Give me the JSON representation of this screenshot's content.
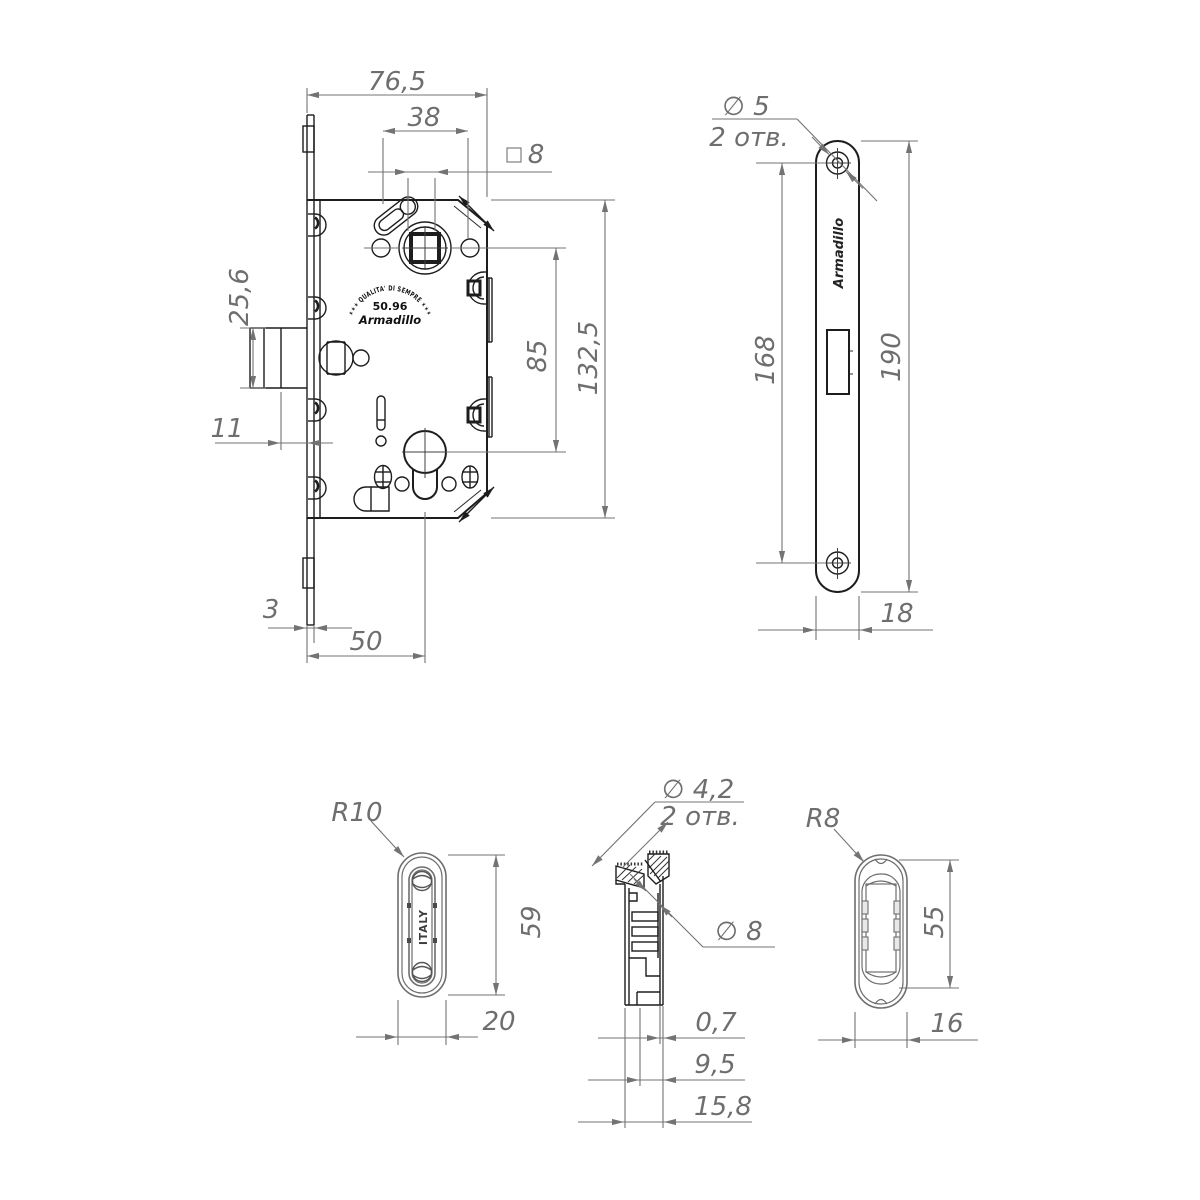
{
  "drawing": {
    "type": "technical-drawing",
    "product": "magnetic mortise lock",
    "lock_body": {
      "dim_total_width": "76,5",
      "dim_handle_span": "38",
      "dim_square_symbol": "□",
      "dim_square_value": "8",
      "dim_latch_height": "25,6",
      "dim_latch_offset": "11",
      "dim_faceplate_thickness": "3",
      "dim_backset": "50",
      "dim_centers_distance": "85",
      "dim_body_height": "132,5",
      "logo": {
        "arc_text": "✶✶✶ QUALITA' DI SEMPRE ✶✶✶",
        "number": "50.96",
        "brand": "Armadillo"
      }
    },
    "face_plate": {
      "hole_diameter": "∅ 5",
      "holes_count": "2 отв.",
      "dim_hole_centers": "168",
      "dim_length": "190",
      "dim_width": "18",
      "brand": "Armadillo"
    },
    "strike_plate_front": {
      "radius": "R10",
      "dim_length": "59",
      "dim_width": "20",
      "country_label": "ITALY"
    },
    "cross_section": {
      "hole_diameter": "∅ 4,2",
      "holes_count": "2 отв.",
      "bore_diameter": "∅ 8",
      "dim_wall": "0,7",
      "dim_inner_depth": "9,5",
      "dim_total_depth": "15,8"
    },
    "strike_plate_back": {
      "radius": "R8",
      "dim_length": "55",
      "dim_width": "16"
    }
  }
}
